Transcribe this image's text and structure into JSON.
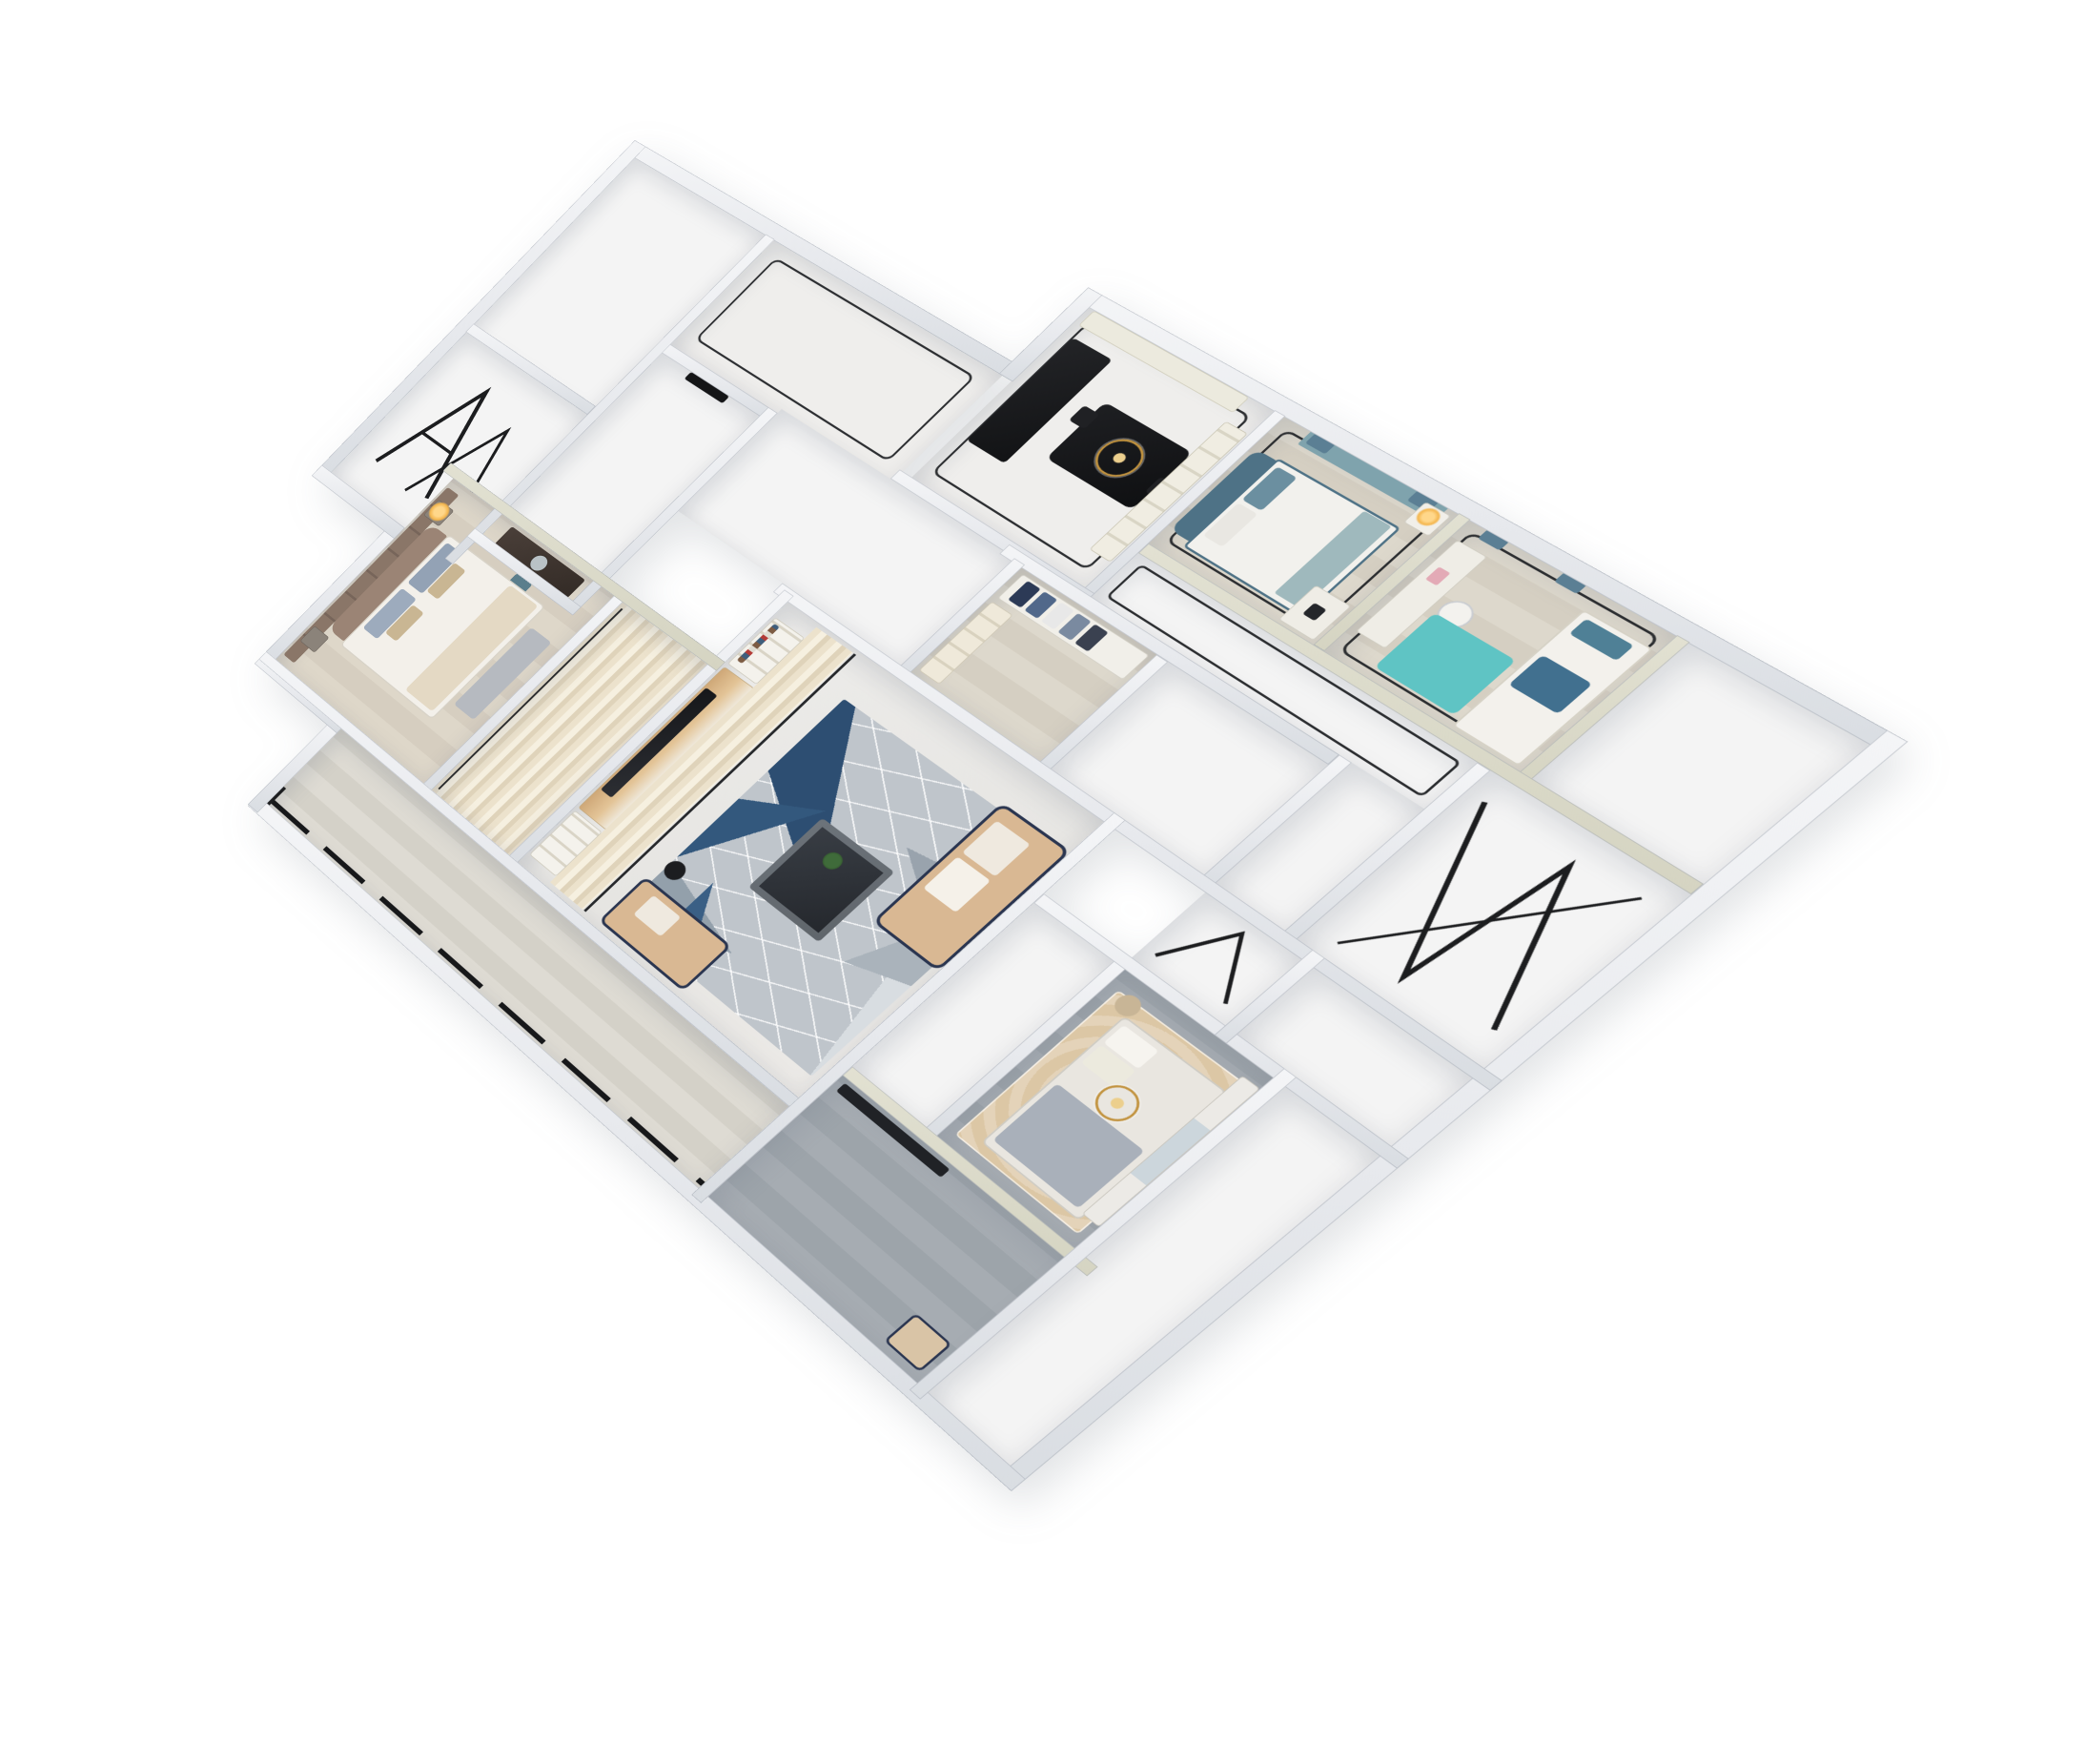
{
  "scene": {
    "image_type": "3d-isometric-dollhouse-floor-plan-render",
    "background_color": "#ffffff",
    "view": "elevated three-quarter cutaway, plan rotated ~40 degrees, no visible text or labels",
    "wall_color": "#e7e9ed",
    "accent_wall_top_color": "#d5d4c2"
  },
  "palette": {
    "walls": "#e7e9ed",
    "floor_white": "#f4f4f4",
    "wood_pale": "#d9d3c6",
    "wood_gray": "#a1a8ae",
    "balcony_wood": "#d9d6cd",
    "marble_band": "#ece2cc",
    "rug_geometric_gray": "#bfc5cb",
    "rug_geometric_blue": "#33587d",
    "rug_ornate_beige": "#dcc7a5",
    "rug_teal": "#5fc4c4",
    "sofa_beige": "#d9b893",
    "sofa_trim_navy": "#2a3550",
    "bed_teal": "#4e7286",
    "headboard_taupe": "#9b8475",
    "dining_table_black": "#17181a",
    "chandelier_gold": "#c2933f",
    "glazing_black": "#1c1d1f",
    "curtain_slate_blue": "#5b7f94"
  },
  "rooms": [
    {
      "id": "utility-a",
      "label": "empty utility room",
      "floor": "white",
      "furniture": []
    },
    {
      "id": "utility-b",
      "label": "empty room with leaning window frames",
      "floor": "white",
      "furniture": [
        "black A-frame window sashes"
      ]
    },
    {
      "id": "foyer",
      "label": "entry foyer",
      "floor": "tile with dark border inlay",
      "furniture": []
    },
    {
      "id": "room-c",
      "label": "empty white room with dark doorway",
      "floor": "white",
      "furniture": []
    },
    {
      "id": "kitchen-dining",
      "label": "kitchen and dining room",
      "floor": "tile",
      "furniture": [
        "black kitchen island",
        "black dining table with chairs",
        "gold chandelier",
        "cream sideboard",
        "north cabinet run"
      ]
    },
    {
      "id": "bedroom-2",
      "label": "bedroom with teal bed",
      "floor": "pale wood",
      "furniture": [
        "teal upholstered bed",
        "white duvet",
        "window seat with teal cushion",
        "nightstand with lamp",
        "desk with laptop",
        "slate blue curtains"
      ]
    },
    {
      "id": "bedroom-3",
      "label": "study bedroom",
      "floor": "pale wood",
      "furniture": [
        "desk with chair and pink accessories",
        "bright teal rug",
        "single bed with teal pillow",
        "navy throw",
        "slate blue curtains"
      ]
    },
    {
      "id": "ne-hall",
      "label": "empty northeast room",
      "floor": "white",
      "furniture": []
    },
    {
      "id": "hallway",
      "label": "hallway with white doors",
      "floor": "white with dark border inlay",
      "furniture": [
        "two white door leaves"
      ]
    },
    {
      "id": "inner-hall",
      "label": "inner hall",
      "floor": "white",
      "furniture": []
    },
    {
      "id": "closet",
      "label": "walk-in closet",
      "floor": "pale wood",
      "furniture": [
        "hanging clothes in navy, blue, white",
        "beige shelf tower"
      ]
    },
    {
      "id": "corridor-c",
      "label": "corridor",
      "floor": "white",
      "furniture": []
    },
    {
      "id": "bath-1",
      "label": "bathroom (unfurnished)",
      "floor": "white",
      "furniture": [
        "black glass partition lines"
      ]
    },
    {
      "id": "bath-2",
      "label": "bathroom (unfurnished)",
      "floor": "white",
      "furniture": [
        "black glass partition lines"
      ]
    },
    {
      "id": "se-room-a",
      "label": "empty room",
      "floor": "white",
      "furniture": []
    },
    {
      "id": "living",
      "label": "living room",
      "floor": "light tile with marble band",
      "furniture": [
        "TV wall with wood slats and black TV",
        "bookshelves with books",
        "geometric gray-blue rug",
        "beige loveseat with navy trim",
        "second beige sofa",
        "dark coffee table with plant",
        "floor lamp"
      ]
    },
    {
      "id": "passage",
      "label": "marble passage",
      "floor": "marble streaks",
      "furniture": []
    },
    {
      "id": "master",
      "label": "master bedroom",
      "floor": "warm wood",
      "furniture": [
        "taupe padded wall panels",
        "curved taupe headboard bed",
        "white duvet with beige throw",
        "blue-gray and tan pillows",
        "gray foot bench",
        "dark vanity desk with chair",
        "nightstands with warm lamp"
      ]
    },
    {
      "id": "corridor-e",
      "label": "corridor to south bedroom",
      "floor": "white",
      "furniture": []
    },
    {
      "id": "bedroom-4",
      "label": "south bedroom",
      "floor": "gray wood",
      "furniture": [
        "ornate beige rug",
        "bed with white duvet and gray blanket",
        "gold chandelier",
        "white wardrobe with glass doors",
        "beige stool"
      ]
    },
    {
      "id": "se-room-b",
      "label": "empty southeast wing",
      "floor": "white",
      "furniture": []
    },
    {
      "id": "gray-room",
      "label": "gray-floor room",
      "floor": "gray wood",
      "furniture": [
        "dark media band",
        "beige armchair"
      ]
    },
    {
      "id": "balcony",
      "label": "long balcony",
      "floor": "pale wood planks",
      "furniture": [
        "black framed glazing along outer edge"
      ]
    }
  ]
}
